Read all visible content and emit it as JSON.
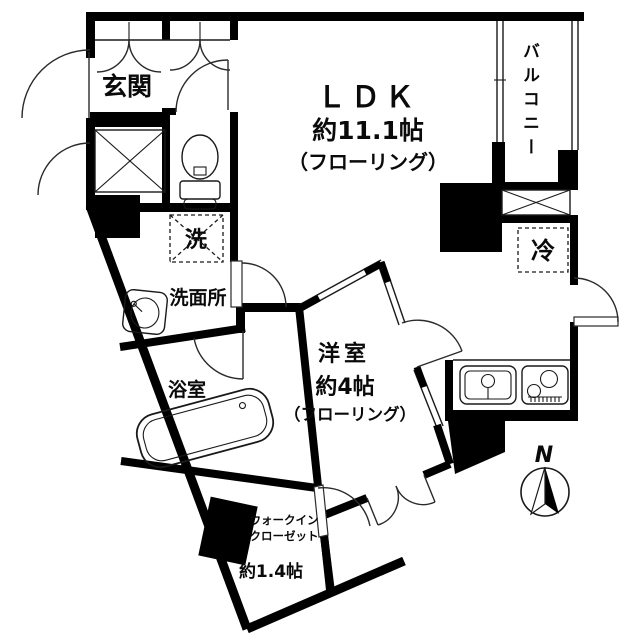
{
  "document": {
    "kind": "japanese-apartment-floor-plan",
    "colors": {
      "wall": "#000000",
      "background": "#ffffff",
      "line": "#2a2a2a"
    }
  },
  "labels": {
    "entrance": "玄関",
    "ldk": "ＬＤＫ",
    "ldk_size": "約11.1帖",
    "ldk_floor": "（フローリング）",
    "balcony": "バルコニー",
    "washer": "洗",
    "washroom": "洗面所",
    "bathroom": "浴室",
    "western_room": "洋室",
    "western_room_size": "約4帖",
    "western_room_floor": "（フローリング）",
    "refrigerator": "冷",
    "wic_line1": "ウォークイン",
    "wic_line2": "クローゼット",
    "wic_size": "約1.4帖",
    "compass_north": "N"
  },
  "icons": {
    "toilet": "toilet-icon",
    "bathtub": "bathtub-icon",
    "vanity_sink": "vanity-sink-icon",
    "kitchen_sink": "kitchen-sink-icon",
    "stove": "stove-icon",
    "compass": "compass-icon",
    "shaft_x_box": "shaft-cross-box",
    "washer_pan": "washer-pan-dashed-box",
    "refrigerator_space": "refrigerator-dashed-box"
  }
}
